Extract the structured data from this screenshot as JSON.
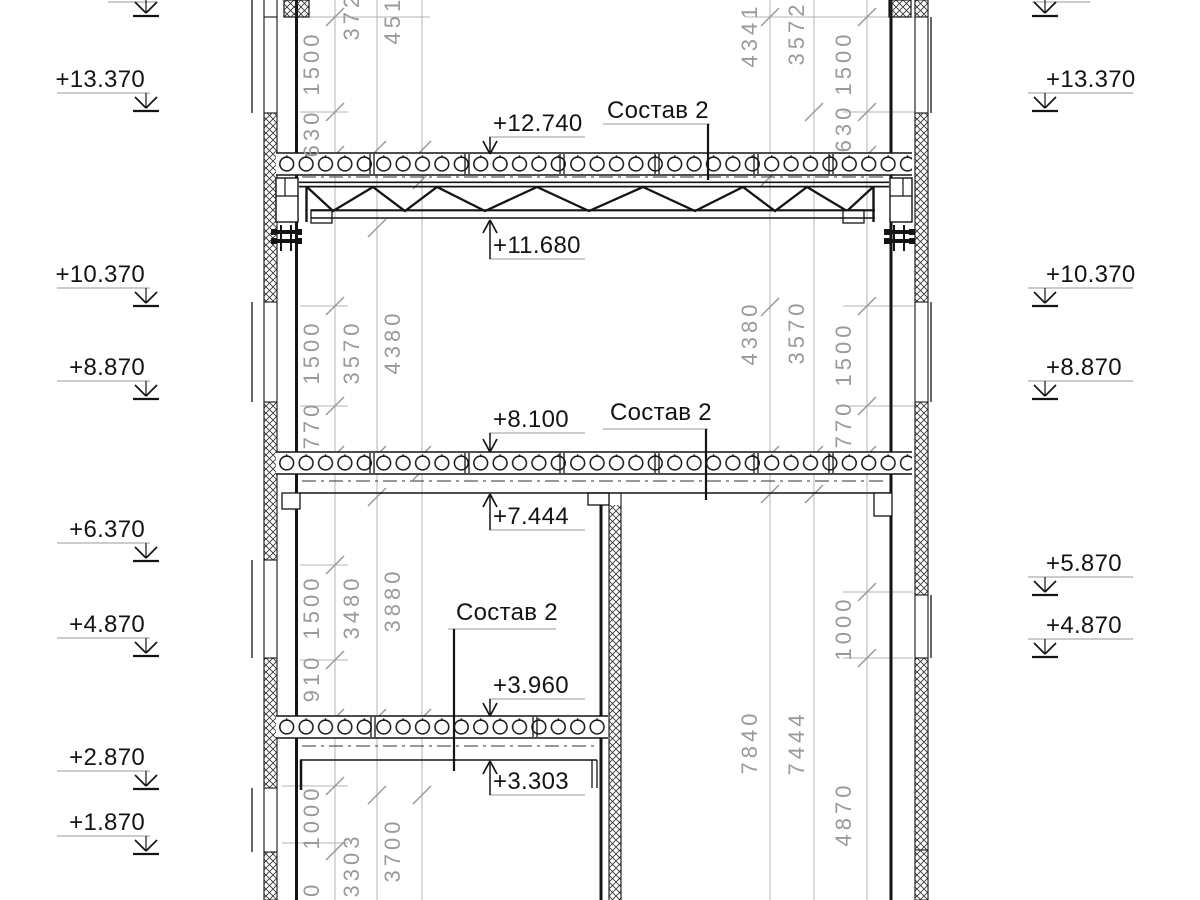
{
  "drawing_type": "building cross-section with hollow-core slabs and steel truss",
  "colors": {
    "line": "#141414",
    "dim_gray": "#9a9a9a",
    "paper": "#ffffff"
  },
  "composition_callouts": [
    "Состав 2",
    "Состав 2",
    "Состав 2"
  ],
  "level_callouts": [
    "+12.740",
    "+11.680",
    "+8.100",
    "+7.444",
    "+3.960",
    "+3.303"
  ],
  "elevation_marks_left": [
    "+13.370",
    "+10.370",
    "+8.870",
    "+6.370",
    "+4.870",
    "+2.870",
    "+1.870"
  ],
  "elevation_marks_right": [
    "+13.370",
    "+10.370",
    "+8.870",
    "+5.870",
    "+4.870"
  ],
  "dimensions": {
    "left_inner": [
      "1500",
      "630",
      "1500",
      "770",
      "1500",
      "910",
      "1000",
      "770"
    ],
    "left_middle": [
      "3724",
      "3570",
      "3480",
      "3303"
    ],
    "left_outer": [
      "4516",
      "4380",
      "3880",
      "3700"
    ],
    "right_inner": [
      "1500",
      "630",
      "1500",
      "770",
      "1000",
      "4870"
    ],
    "right_middle": [
      "3572",
      "3570",
      "7444"
    ],
    "right_outer": [
      "4341",
      "4380",
      "7840"
    ]
  }
}
